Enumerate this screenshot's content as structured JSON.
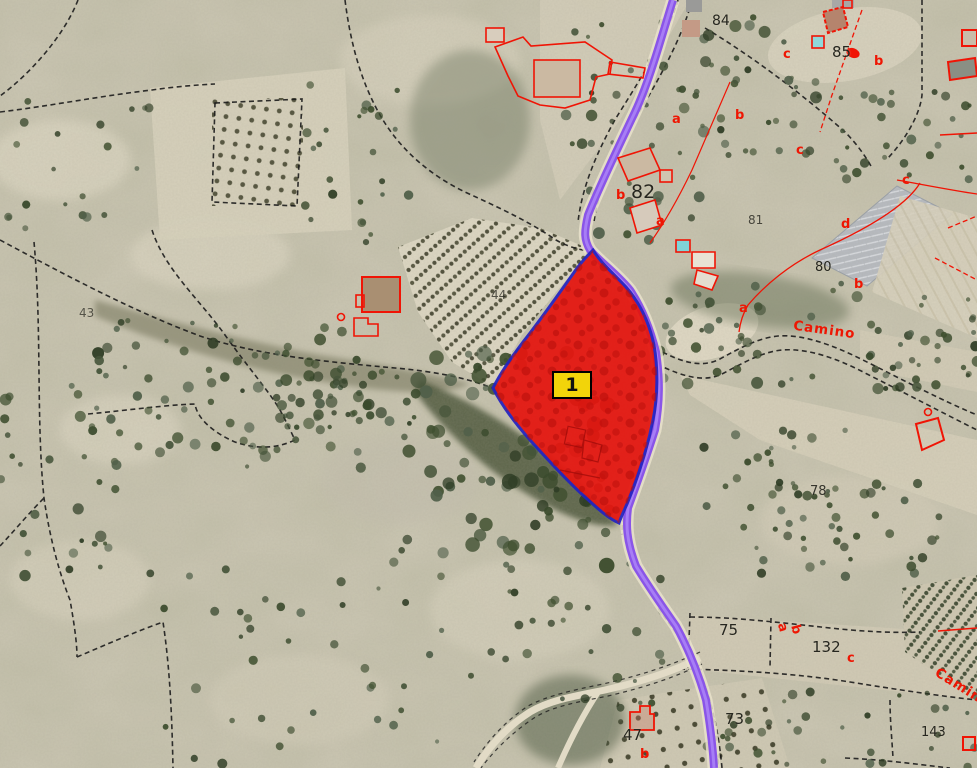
{
  "map": {
    "title": "Aerial cadastral map with highlighted parcel",
    "marker": {
      "label": "1",
      "bg": "#f2d40a",
      "border": "#000000"
    },
    "highlight_parcel": {
      "number": "1",
      "fill": "#e5150f",
      "border": "#2323c0"
    },
    "colors": {
      "road_purple": "#8a55e8",
      "road_core": "#a77ef5",
      "road_shoulder": "#e9e2cb",
      "cadastral_red": "#f01405",
      "boundary_black": "#1c1c1c",
      "terrain": "#ccc7b4"
    },
    "labels": {
      "parcel_numbers": [
        {
          "text": "84",
          "x": 712,
          "y": 14,
          "size": 14
        },
        {
          "text": "85",
          "x": 832,
          "y": 45,
          "size": 15
        },
        {
          "text": "82",
          "x": 631,
          "y": 183,
          "size": 19
        },
        {
          "text": "81",
          "x": 748,
          "y": 214,
          "size": 12,
          "opacity": 0.8
        },
        {
          "text": "80",
          "x": 815,
          "y": 261,
          "size": 13
        },
        {
          "text": "44",
          "x": 491,
          "y": 289,
          "size": 12,
          "opacity": 0.75
        },
        {
          "text": "43",
          "x": 79,
          "y": 307,
          "size": 12,
          "opacity": 0.7
        },
        {
          "text": "78",
          "x": 810,
          "y": 485,
          "size": 13,
          "opacity": 0.9
        },
        {
          "text": "75",
          "x": 719,
          "y": 623,
          "size": 15
        },
        {
          "text": "132",
          "x": 812,
          "y": 640,
          "size": 15
        },
        {
          "text": "73",
          "x": 725,
          "y": 712,
          "size": 15
        },
        {
          "text": "47",
          "x": 623,
          "y": 728,
          "size": 15
        },
        {
          "text": "143",
          "x": 921,
          "y": 726,
          "size": 13
        }
      ],
      "subparcel_letters": [
        {
          "text": "c",
          "x": 783,
          "y": 48
        },
        {
          "text": "b",
          "x": 874,
          "y": 55
        },
        {
          "text": "a",
          "x": 672,
          "y": 113
        },
        {
          "text": "b",
          "x": 735,
          "y": 109
        },
        {
          "text": "c",
          "x": 796,
          "y": 144
        },
        {
          "text": "b",
          "x": 616,
          "y": 189
        },
        {
          "text": "a",
          "x": 656,
          "y": 215
        },
        {
          "text": "c",
          "x": 902,
          "y": 174
        },
        {
          "text": "d",
          "x": 841,
          "y": 218
        },
        {
          "text": "b",
          "x": 854,
          "y": 278
        },
        {
          "text": "a",
          "x": 739,
          "y": 302
        },
        {
          "text": "c",
          "x": 847,
          "y": 652
        },
        {
          "text": "b",
          "x": 640,
          "y": 748
        },
        {
          "text": "a",
          "x": 778,
          "y": 621,
          "rot": 75
        },
        {
          "text": "b",
          "x": 791,
          "y": 623,
          "rot": 75
        }
      ],
      "road_names": [
        {
          "text": "Camino",
          "x": 793,
          "y": 324,
          "rot": 8
        },
        {
          "text": "Camino",
          "x": 931,
          "y": 682,
          "rot": 32
        }
      ]
    }
  }
}
